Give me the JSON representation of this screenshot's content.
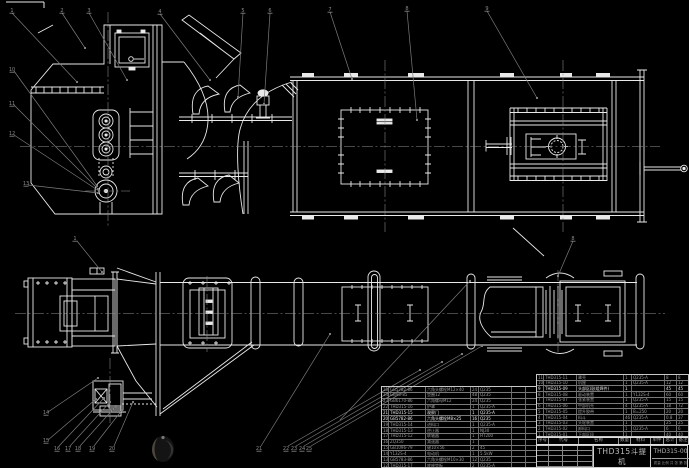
{
  "title_block": {
    "product_title_line1": "THD315斗提机",
    "product_title_line2": "装配图",
    "drawing_number": "THD315-00",
    "footer_row": "质量 比例 共 张 第 张"
  },
  "bom_header": {
    "labels": [
      "序号",
      "代号",
      "名称",
      "数量",
      "材料",
      "单件",
      "总计",
      "备注"
    ],
    "col_widths": [
      12,
      30,
      40,
      12,
      20,
      13,
      13,
      13
    ]
  },
  "bom_right": {
    "col_widths": [
      7,
      33,
      47,
      8,
      33,
      12,
      13
    ],
    "bright_rows": [
      2
    ],
    "rows": [
      [
        "11",
        "THD315-11",
        "罩壳",
        "1",
        "Q235-A",
        "8",
        "8"
      ],
      [
        "10",
        "THD315-10",
        "机座",
        "1",
        "Q235-A",
        "12",
        "12"
      ],
      [
        "9",
        "THD315-09",
        "头部区段(组焊件)",
        "1",
        "",
        "45",
        "45"
      ],
      [
        "8",
        "THD315-08",
        "驱动装置",
        "1",
        "Y132S-4",
        "60",
        "60"
      ],
      [
        "7",
        "THD315-07",
        "张紧装置",
        "1",
        "Q235-A",
        "15",
        "15"
      ],
      [
        "6",
        "THD315-06",
        "中部机壳",
        "4",
        "Q235-A",
        "18",
        "72"
      ],
      [
        "5",
        "THD315-05",
        "提升胶带",
        "1",
        "B=250",
        "20",
        "20"
      ],
      [
        "4",
        "THD315-04",
        "料斗",
        "46",
        "Q235-A",
        "0.8",
        "37"
      ],
      [
        "3",
        "THD315-03",
        "头轮装置",
        "1",
        "",
        "25",
        "25"
      ],
      [
        "2",
        "THD315-02",
        "卸料口",
        "1",
        "Q235-A",
        "6",
        "6"
      ],
      [
        "1",
        "THD315-01",
        "下部区段",
        "1",
        "",
        "40",
        "40"
      ]
    ]
  },
  "bom_left": {
    "col_widths": [
      7,
      37,
      45,
      8,
      33,
      14,
      12
    ],
    "bright_rows": [
      4,
      5
    ],
    "rows": [
      [
        "25",
        "GB5782-86",
        "六角头螺栓M12×40",
        "24",
        "Q235",
        "",
        ""
      ],
      [
        "24",
        "GB95-85",
        "垫圈12",
        "48",
        "Q235",
        "",
        ""
      ],
      [
        "23",
        "GB6170-86",
        "六角螺母M12",
        "24",
        "Q235",
        "",
        ""
      ],
      [
        "22",
        "THD315-16",
        "护罩",
        "1",
        "Q235-A",
        "",
        ""
      ],
      [
        "21",
        "THD315-15",
        "观察门",
        "1",
        "Q235-A",
        "",
        ""
      ],
      [
        "20",
        "GB5782-86",
        "六角头螺栓M8×25",
        "16",
        "Q235",
        "",
        ""
      ],
      [
        "19",
        "THD315-14",
        "进料口",
        "1",
        "Q235-A",
        "",
        ""
      ],
      [
        "18",
        "THD315-13",
        "逆止器",
        "1",
        "NJ30",
        "",
        ""
      ],
      [
        "17",
        "THD315-12",
        "联轴器",
        "1",
        "HT200",
        "",
        ""
      ],
      [
        "16",
        "ZQ350",
        "减速器",
        "1",
        "",
        "",
        ""
      ],
      [
        "15",
        "GB1096-79",
        "键10×56",
        "2",
        "45",
        "",
        ""
      ],
      [
        "14",
        "Y132S-4",
        "电动机",
        "1",
        "5.5kW",
        "",
        ""
      ],
      [
        "13",
        "GB5783-86",
        "六角头螺栓M10×30",
        "12",
        "Q235",
        "",
        ""
      ],
      [
        "12",
        "THD315-17",
        "底座垫板",
        "2",
        "Q235-A",
        "",
        ""
      ]
    ]
  },
  "annotations": {
    "balloons": [
      {
        "x": 12,
        "y": 10,
        "label": "1"
      },
      {
        "x": 62,
        "y": 10,
        "label": "2"
      },
      {
        "x": 89,
        "y": 10,
        "label": "3"
      },
      {
        "x": 160,
        "y": 11,
        "label": "4"
      },
      {
        "x": 243,
        "y": 10,
        "label": "5"
      },
      {
        "x": 270,
        "y": 10,
        "label": "6"
      },
      {
        "x": 330,
        "y": 9,
        "label": "7"
      },
      {
        "x": 407,
        "y": 8,
        "label": "8"
      },
      {
        "x": 487,
        "y": 8,
        "label": "9"
      },
      {
        "x": 12,
        "y": 69,
        "label": "10"
      },
      {
        "x": 12,
        "y": 103,
        "label": "11"
      },
      {
        "x": 12,
        "y": 133,
        "label": "12"
      },
      {
        "x": 26,
        "y": 183,
        "label": "13"
      },
      {
        "x": 75,
        "y": 238,
        "label": "1"
      },
      {
        "x": 573,
        "y": 238,
        "label": "8"
      },
      {
        "x": 46,
        "y": 412,
        "label": "14"
      },
      {
        "x": 46,
        "y": 440,
        "label": "15"
      },
      {
        "x": 57,
        "y": 448,
        "label": "16"
      },
      {
        "x": 68,
        "y": 448,
        "label": "17"
      },
      {
        "x": 78,
        "y": 448,
        "label": "18"
      },
      {
        "x": 92,
        "y": 448,
        "label": "19"
      },
      {
        "x": 112,
        "y": 448,
        "label": "20"
      },
      {
        "x": 259,
        "y": 448,
        "label": "21"
      },
      {
        "x": 286,
        "y": 448,
        "label": "22"
      },
      {
        "x": 294,
        "y": 448,
        "label": "23"
      },
      {
        "x": 302,
        "y": 448,
        "label": "24"
      },
      {
        "x": 309,
        "y": 448,
        "label": "25"
      }
    ],
    "leaders": [
      [
        12,
        13,
        77,
        82
      ],
      [
        62,
        13,
        85,
        48
      ],
      [
        89,
        13,
        127,
        80
      ],
      [
        160,
        14,
        210,
        80
      ],
      [
        243,
        13,
        238,
        97
      ],
      [
        270,
        13,
        264,
        104
      ],
      [
        330,
        12,
        352,
        79
      ],
      [
        407,
        11,
        417,
        120
      ],
      [
        487,
        11,
        537,
        98
      ],
      [
        14,
        71,
        97,
        186
      ],
      [
        14,
        105,
        98,
        189
      ],
      [
        14,
        135,
        99,
        191
      ],
      [
        28,
        185,
        98,
        193
      ],
      [
        77,
        241,
        102,
        272
      ],
      [
        573,
        241,
        558,
        276
      ],
      [
        48,
        412,
        98,
        378
      ],
      [
        48,
        440,
        96,
        399
      ],
      [
        59,
        446,
        104,
        398
      ],
      [
        70,
        446,
        110,
        402
      ],
      [
        80,
        446,
        116,
        406
      ],
      [
        94,
        446,
        122,
        410
      ],
      [
        114,
        446,
        133,
        402
      ],
      [
        261,
        446,
        330,
        334
      ],
      [
        288,
        446,
        420,
        370
      ],
      [
        296,
        446,
        442,
        362
      ],
      [
        304,
        446,
        462,
        354
      ],
      [
        311,
        446,
        482,
        346
      ],
      [
        340,
        420,
        470,
        281
      ]
    ]
  }
}
